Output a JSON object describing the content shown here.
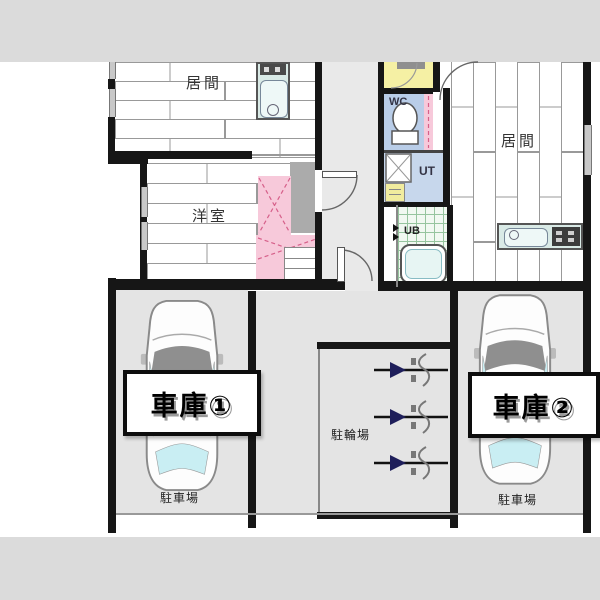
{
  "title": "2-unit apartment floor plan with garages",
  "colors": {
    "strip": "#dbdbdb",
    "wall": "#161616",
    "floor_line": "#8a8a8a",
    "corridor": "#e9e9e9",
    "garage": "#e4e4e4",
    "closet_gray": "#ababab",
    "pink": "#f7c9da",
    "pink_dash": "#d6608a",
    "wc_blue": "#b9cde8",
    "ut_blue": "#c7d7ec",
    "entrance_yellow": "#f5f0a4",
    "basin_yellow": "#f1ec9e",
    "ub_green_line": "#96c49e",
    "ub_bg": "#f1f8f1",
    "counter": "#d9eae6",
    "sink": "#eef8f7",
    "window_glass": "#c9eef3",
    "windshield": "#8f8f8f",
    "arrow_navy": "#1e1e5a",
    "window_gray": "#c8c8c8"
  },
  "rooms": {
    "living_left": "居間",
    "western_room": "洋室",
    "living_right": "居間",
    "wc": "WC",
    "ut": "UT",
    "ub": "UB"
  },
  "parking": {
    "garage1": "車庫①",
    "garage2": "車庫②",
    "car_park_left": "駐車場",
    "car_park_right": "駐車場",
    "bicycle_park": "駐輪場"
  }
}
